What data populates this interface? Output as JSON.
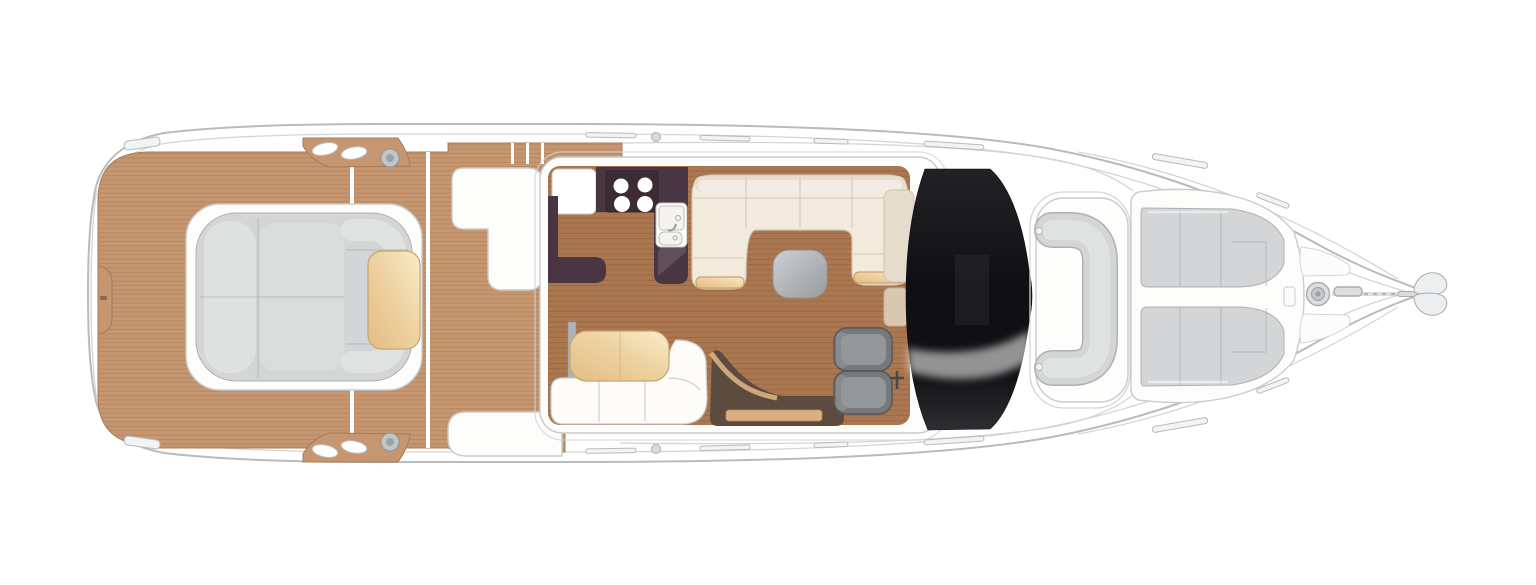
{
  "meta": {
    "title": "Motor yacht main-deck floor plan",
    "view": "top-down plan",
    "orientation": "bow-right-stern-left"
  },
  "colors": {
    "bg": "#ffffff",
    "hull-line": "#b7bbbe",
    "hull-line2": "#d2d5d7",
    "teak": "#c5966f",
    "teak-line": "#a87c58",
    "floor": "#aa7750",
    "floor-line": "#8e5c36",
    "dark-galley": "#4a3642",
    "dark-hob": "#3d2b36",
    "white-furn": "#fdfdfb",
    "furn-line": "#c9cccc",
    "sofa-cream": "#f2ebdd",
    "sofa-band": "#e9dccd",
    "sofa-line": "#cfc5b2",
    "tan-lo": "#e3bc85",
    "tan-mid": "#eed3a2",
    "tan-hi": "#f8ecc9",
    "tan-line": "#c9a369",
    "tan-step": "#d9b083",
    "pad-grey": "#d3d5d6",
    "pad-grey2": "#e0e2e2",
    "pad-line": "#aeb1b3",
    "seat-grey": "#75797c",
    "seat-grey2": "#94989b",
    "seat-line": "#55595c",
    "stairs-dark": "#5d4b3f",
    "dash-beige": "#e6dccb",
    "grey-a": "#cdd0d2",
    "grey-b": "#979b9e",
    "glaze-a": "#222226",
    "glaze-b": "#101013",
    "glaze-c": "#2e2e32"
  },
  "features": {
    "hob_burners": 4,
    "galley_sinks": 2,
    "helm_seats": 2,
    "bow_sunpads": 2,
    "aft_sunpad_sections": 3,
    "tables": 3,
    "deck_winches": 2,
    "rail_segments_per_side": 6,
    "windlass": 1,
    "anchor": 1
  },
  "regions": [
    {
      "id": "swim-platform",
      "label": "teak swim platform"
    },
    {
      "id": "aft-sunpad",
      "label": "aft-facing sunpad with backrest and tan pad"
    },
    {
      "id": "cockpit-deck",
      "label": "teak cockpit deck"
    },
    {
      "id": "cockpit-wet-bar",
      "label": "white cockpit unit port-aft"
    },
    {
      "id": "cockpit-seat",
      "label": "white cockpit seat starboard-aft"
    },
    {
      "id": "galley",
      "label": "galley with hob and sinks"
    },
    {
      "id": "salon-sofa",
      "label": "U-shaped cream sofa with grey table"
    },
    {
      "id": "dinette",
      "label": "dinette sofa with tan table"
    },
    {
      "id": "companionway",
      "label": "stairs to lower deck"
    },
    {
      "id": "helm",
      "label": "twin helm seats"
    },
    {
      "id": "windscreen",
      "label": "black wraparound windscreen"
    },
    {
      "id": "foredeck-lounge",
      "label": "C-shaped foredeck lounge"
    },
    {
      "id": "bow-sunpads",
      "label": "twin bow sunpads"
    },
    {
      "id": "ground-tackle",
      "label": "windlass, chain and anchor"
    }
  ]
}
